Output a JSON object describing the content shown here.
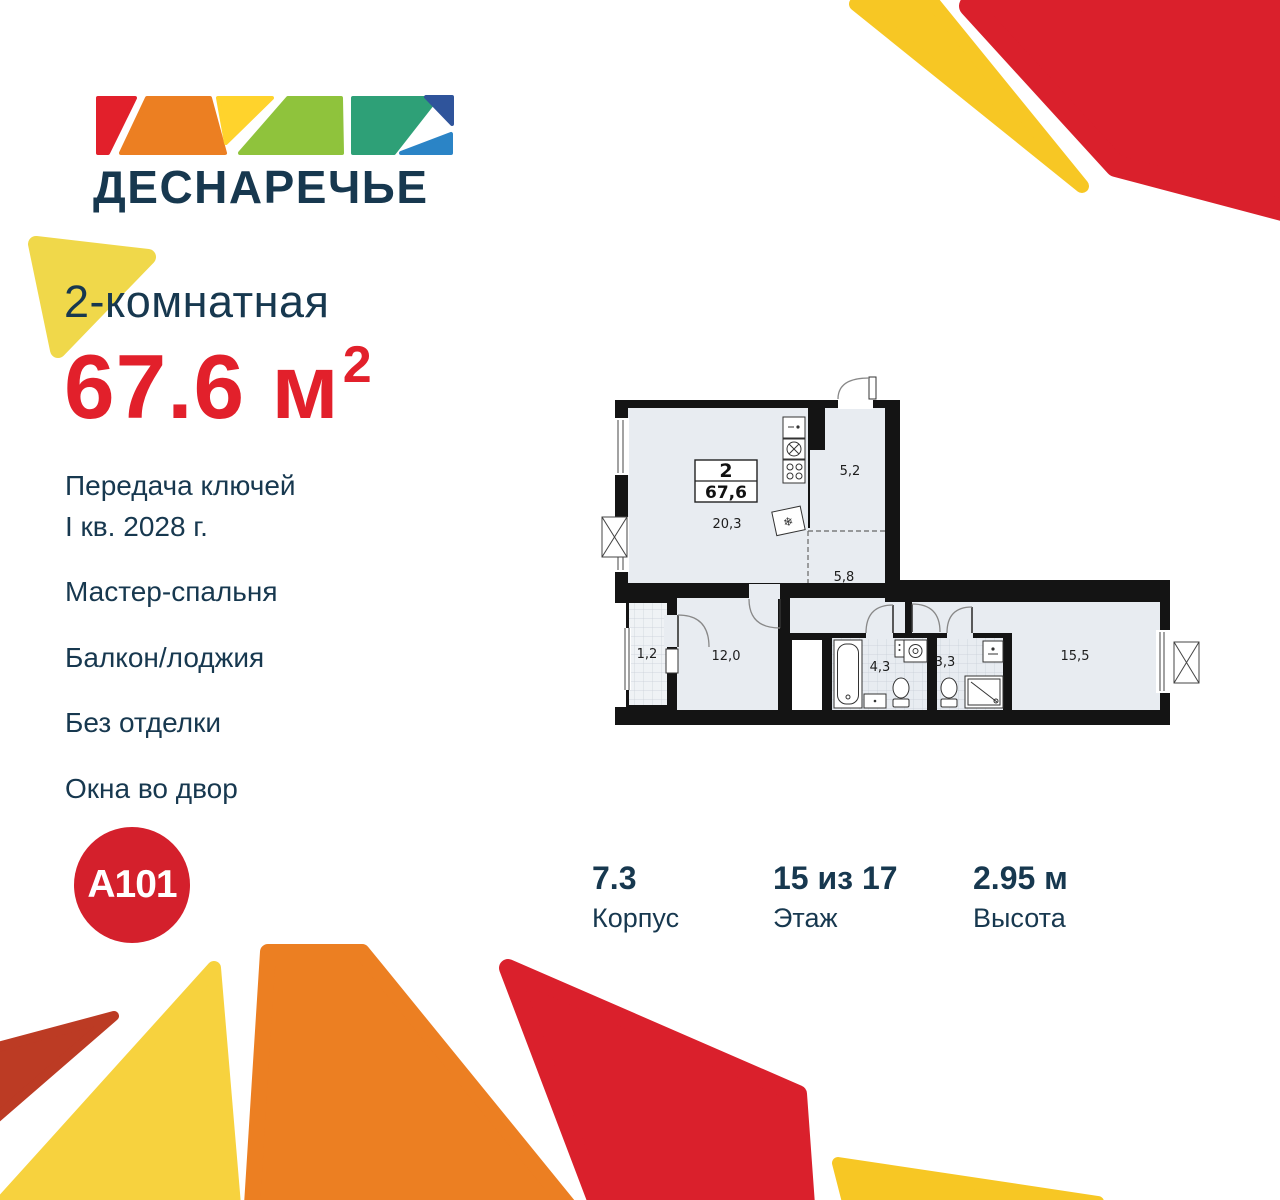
{
  "brand": {
    "project_name": "ДЕСНАРЕЧЬЕ",
    "developer_name": "A101"
  },
  "listing": {
    "title": "2-комнатная",
    "area": {
      "value": "67.6",
      "unit": "м",
      "power": "2"
    },
    "features": [
      "Передача ключей\nI кв. 2028 г.",
      "Мастер-спальня",
      "Балкон/лоджия",
      "Без отделки",
      "Окна во двор"
    ]
  },
  "floorplan": {
    "badge": {
      "rooms": "2",
      "area": "67,6"
    },
    "rooms": [
      {
        "name": "kitchen-living",
        "area": "20,3"
      },
      {
        "name": "hallway-entry",
        "area": "5,2"
      },
      {
        "name": "hallway",
        "area": "5,8"
      },
      {
        "name": "balcony",
        "area": "1,2"
      },
      {
        "name": "bedroom",
        "area": "12,0"
      },
      {
        "name": "bathroom",
        "area": "4,3"
      },
      {
        "name": "bathroom-2",
        "area": "3,3"
      },
      {
        "name": "master-bedroom",
        "area": "15,5"
      }
    ]
  },
  "stats": [
    {
      "value": "7.3",
      "label": "Корпус"
    },
    {
      "value": "15 из 17",
      "label": "Этаж"
    },
    {
      "value": "2.95 м",
      "label": "Высота"
    }
  ],
  "colors": {
    "navy": "#17384F",
    "brand_red": "#E2202B",
    "shape_red": "#DA202C",
    "shape_orange": "#EC7F22",
    "shape_yellow_gold": "#F7C724",
    "shape_yellow_big": "#F7D23E",
    "shape_yellow_soft": "#F0D84A",
    "shape_brick_red": "#BC3B24",
    "logo_green_light": "#8FC33C",
    "logo_teal": "#2EA077",
    "logo_blue_dark": "#2F549B",
    "logo_blue": "#2B84C6",
    "plan_room_fill": "#E8ECF1"
  }
}
